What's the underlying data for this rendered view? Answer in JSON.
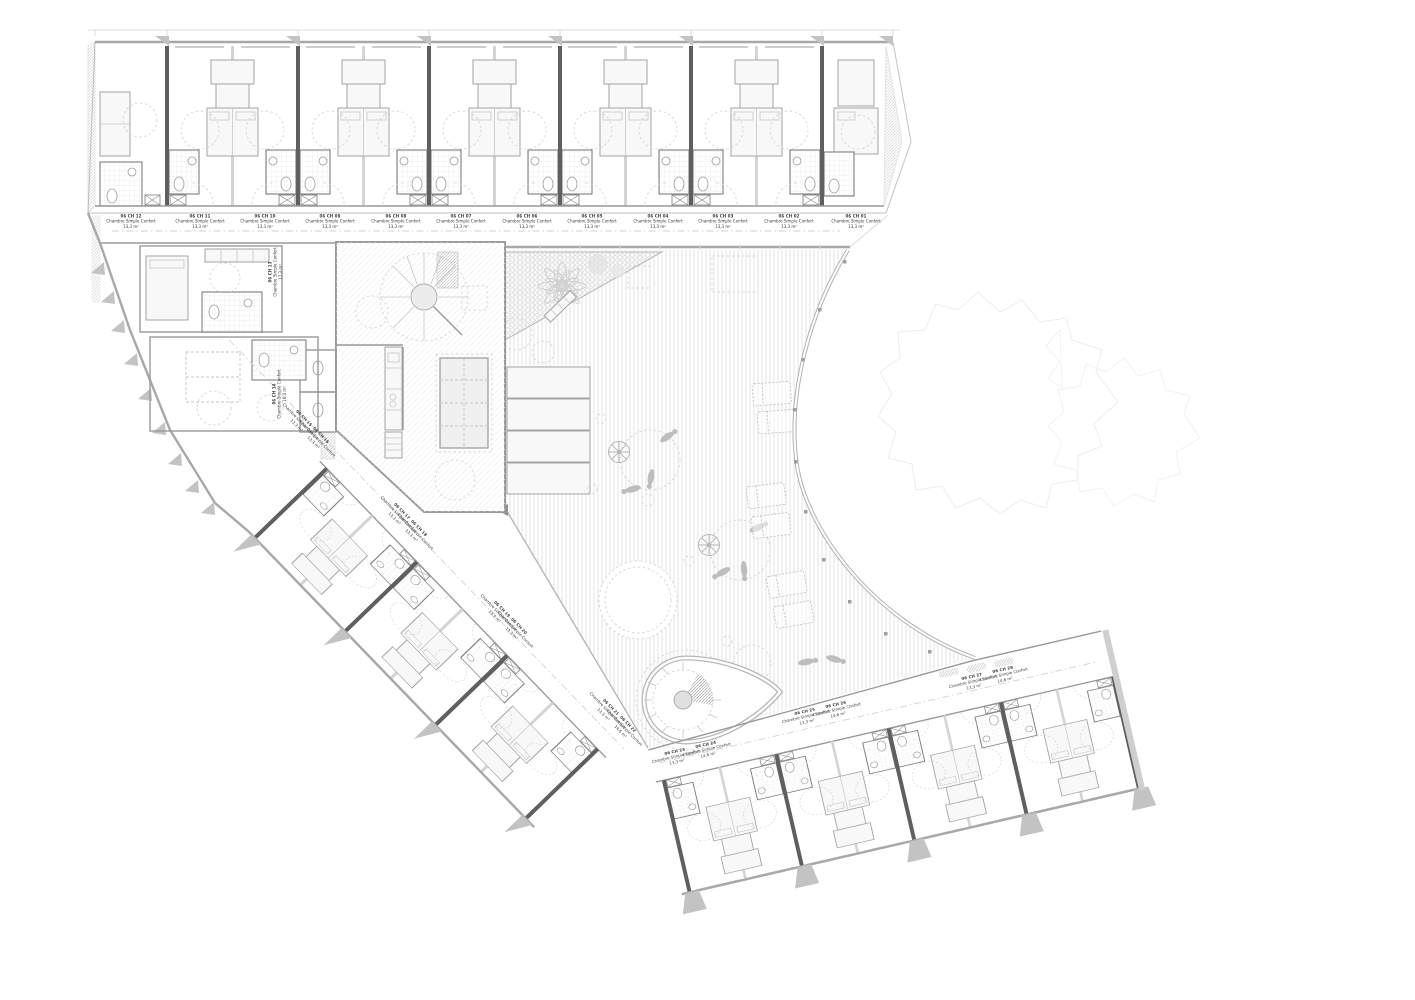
{
  "drawing": {
    "level_prefix": "06 CH",
    "room_type_standard": "Chambre Simple Confort"
  },
  "rooms": {
    "top_wing": [
      {
        "id": "06 CH 12",
        "type": "Chambre Simple Confort",
        "area": "13,3 m²"
      },
      {
        "id": "06 CH 11",
        "type": "Chambre Simple Confort",
        "area": "13,3 m²"
      },
      {
        "id": "06 CH 10",
        "type": "Chambre Simple Confort",
        "area": "13,3 m²"
      },
      {
        "id": "06 CH 09",
        "type": "Chambre Simple Confort",
        "area": "13,3 m²"
      },
      {
        "id": "06 CH 08",
        "type": "Chambre Simple Confort",
        "area": "13,3 m²"
      },
      {
        "id": "06 CH 07",
        "type": "Chambre Simple Confort",
        "area": "13,3 m²"
      },
      {
        "id": "06 CH 06",
        "type": "Chambre Simple Confort",
        "area": "13,3 m²"
      },
      {
        "id": "06 CH 05",
        "type": "Chambre Simple Confort",
        "area": "13,3 m²"
      },
      {
        "id": "06 CH 04",
        "type": "Chambre Simple Confort",
        "area": "13,3 m²"
      },
      {
        "id": "06 CH 03",
        "type": "Chambre Simple Confort",
        "area": "13,3 m²"
      },
      {
        "id": "06 CH 02",
        "type": "Chambre Simple Confort",
        "area": "13,3 m²"
      },
      {
        "id": "06 CH 01",
        "type": "Chambre Simple Confort",
        "area": "13,3 m²"
      }
    ],
    "west_block": [
      {
        "id": "06 CH 13",
        "type": "Chambre Simple Confort",
        "area": "17,3 m²"
      },
      {
        "id": "06 CH 14",
        "type": "Chambre Simple Confort",
        "area": "16,4 m²"
      }
    ],
    "diagonal_wing": [
      {
        "id": "06 CH 15",
        "type": "Chambre Simple Confort",
        "area": "13,3 m²"
      },
      {
        "id": "06 CH 16",
        "type": "Chambre Simple Confort",
        "area": "13,3 m²"
      },
      {
        "id": "06 CH 17",
        "type": "Chambre Simple Confort",
        "area": "13,3 m²"
      },
      {
        "id": "06 CH 18",
        "type": "Chambre Simple Confort",
        "area": "13,3 m²"
      },
      {
        "id": "06 CH 19",
        "type": "Chambre Simple Confort",
        "area": "13,3 m²"
      },
      {
        "id": "06 CH 20",
        "type": "Chambre Simple Confort",
        "area": "13,3 m²"
      }
    ],
    "south_wing": [
      {
        "id": "06 CH 21",
        "type": "Chambre Simple Confort",
        "area": "13,3 m²"
      },
      {
        "id": "06 CH 22",
        "type": "Chambre Simple Confort",
        "area": "14,6 m²"
      },
      {
        "id": "06 CH 23",
        "type": "Chambre Simple Confort",
        "area": "13,3 m²"
      },
      {
        "id": "06 CH 24",
        "type": "Chambre Simple Confort",
        "area": "14,6 m²"
      },
      {
        "id": "06 CH 25",
        "type": "Chambre Simple Confort",
        "area": "13,3 m²"
      },
      {
        "id": "06 CH 26",
        "type": "Chambre Simple Confort",
        "area": "14,6 m²"
      },
      {
        "id": "06 CH 27",
        "type": "Chambre Simple Confort",
        "area": "13,3 m²"
      },
      {
        "id": "06 CH 28",
        "type": "Chambre Simple Confort",
        "area": "14,6 m²"
      }
    ]
  },
  "features": [
    "spiral-staircase-main",
    "spiral-staircase-terrace",
    "communal-table",
    "kitchen-counter",
    "palm-tree",
    "garden-bench",
    "sun-umbrella",
    "lounge-chairs",
    "terrace-decking",
    "tree-canopy",
    "bathroom-pod",
    "bed",
    "wardrobe",
    "shaft",
    "railing"
  ],
  "colors": {
    "wall_dark": "#5f5f5f",
    "wall_light": "#d4d4d4",
    "line": "#9a9a9a",
    "terrace_hatch": "#e3e3e3",
    "fin": "#c3c3c3",
    "figure": "#bdbdbd",
    "text": "#3c3c3c",
    "background": "#ffffff"
  }
}
